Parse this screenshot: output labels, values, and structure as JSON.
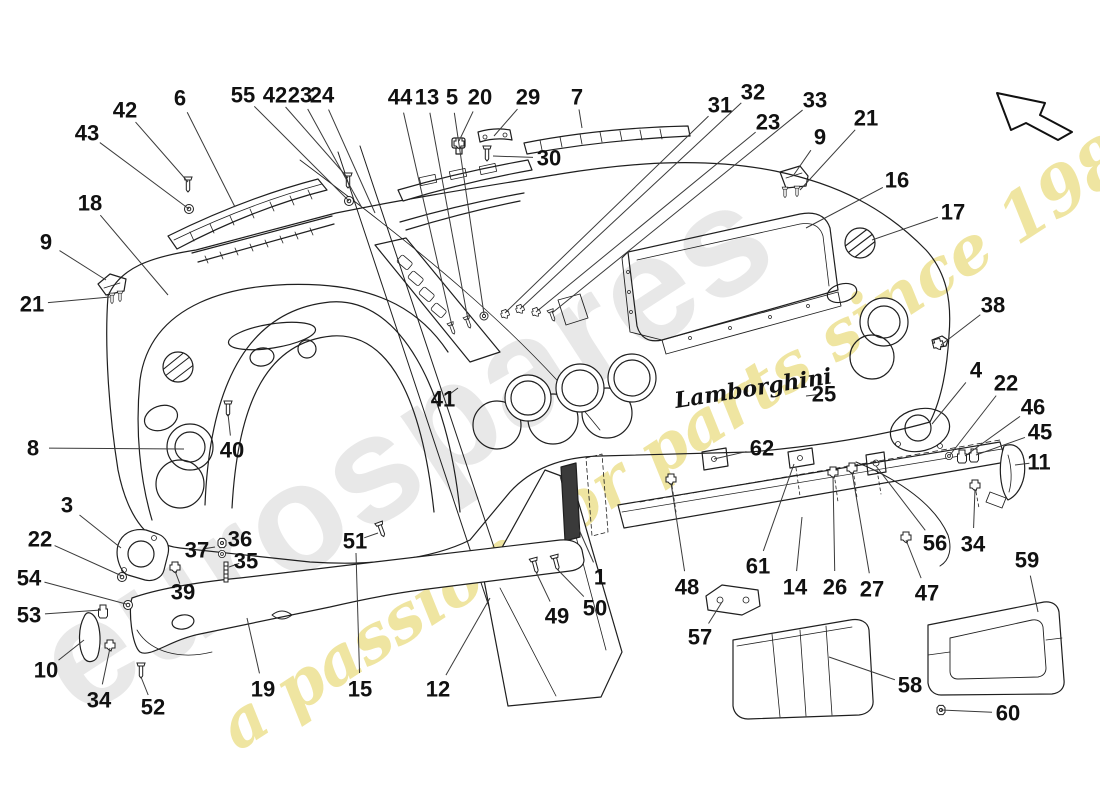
{
  "diagram": {
    "brand_script": "Lamborghini",
    "watermark_brand": "eurospares",
    "watermark_tagline": "a passion for parts since 1985"
  },
  "style": {
    "background": "#ffffff",
    "line_color": "#1f1f1f",
    "leader_color": "#3a3a3a",
    "label_color": "#111111",
    "label_font_size": 22,
    "watermark_brand_color": "#e7e7e7",
    "watermark_tagline_color": "#ecdf8a",
    "dark_part_color": "#3a3a3a"
  },
  "callouts": [
    {
      "n": "43",
      "x": 87,
      "y": 133,
      "tx": 189,
      "ty": 209
    },
    {
      "n": "42",
      "x": 125,
      "y": 110,
      "tx": 188,
      "ty": 182
    },
    {
      "n": "6",
      "x": 180,
      "y": 98,
      "tx": 235,
      "ty": 207
    },
    {
      "n": "55",
      "x": 243,
      "y": 95,
      "tx": 349,
      "ty": 201
    },
    {
      "n": "42",
      "x": 275,
      "y": 95,
      "tx": 348,
      "ty": 178
    },
    {
      "n": "23",
      "x": 300,
      "y": 95,
      "tx": 362,
      "ty": 208
    },
    {
      "n": "24",
      "x": 322,
      "y": 95,
      "tx": 375,
      "ty": 213
    },
    {
      "n": "44",
      "x": 400,
      "y": 97,
      "tx": 452,
      "ty": 326
    },
    {
      "n": "13",
      "x": 427,
      "y": 97,
      "tx": 468,
      "ty": 320
    },
    {
      "n": "5",
      "x": 452,
      "y": 97,
      "tx": 484,
      "ty": 314
    },
    {
      "n": "20",
      "x": 480,
      "y": 97,
      "tx": 459,
      "ty": 141
    },
    {
      "n": "29",
      "x": 528,
      "y": 97,
      "tx": 494,
      "ty": 136
    },
    {
      "n": "7",
      "x": 577,
      "y": 97,
      "tx": 582,
      "ty": 128
    },
    {
      "n": "30",
      "x": 549,
      "y": 158,
      "tx": 493,
      "ty": 156
    },
    {
      "n": "31",
      "x": 720,
      "y": 105,
      "tx": 505,
      "ty": 313
    },
    {
      "n": "32",
      "x": 753,
      "y": 92,
      "tx": 520,
      "ty": 309
    },
    {
      "n": "23",
      "x": 768,
      "y": 122,
      "tx": 536,
      "ty": 312
    },
    {
      "n": "33",
      "x": 815,
      "y": 100,
      "tx": 552,
      "ty": 313
    },
    {
      "n": "9",
      "x": 820,
      "y": 137,
      "tx": 793,
      "ty": 176
    },
    {
      "n": "21",
      "x": 866,
      "y": 118,
      "tx": 800,
      "ty": 190
    },
    {
      "n": "16",
      "x": 897,
      "y": 180,
      "tx": 806,
      "ty": 228
    },
    {
      "n": "17",
      "x": 953,
      "y": 212,
      "tx": 872,
      "ty": 240
    },
    {
      "n": "18",
      "x": 90,
      "y": 203,
      "tx": 168,
      "ty": 295
    },
    {
      "n": "9",
      "x": 46,
      "y": 242,
      "tx": 106,
      "ty": 280
    },
    {
      "n": "21",
      "x": 32,
      "y": 304,
      "tx": 110,
      "ty": 297
    },
    {
      "n": "8",
      "x": 33,
      "y": 448,
      "tx": 184,
      "ty": 449
    },
    {
      "n": "40",
      "x": 232,
      "y": 450,
      "tx": 228,
      "ty": 414
    },
    {
      "n": "41",
      "x": 443,
      "y": 399,
      "tx": 458,
      "ty": 388
    },
    {
      "n": "3",
      "x": 67,
      "y": 505,
      "tx": 121,
      "ty": 548
    },
    {
      "n": "22",
      "x": 40,
      "y": 539,
      "tx": 122,
      "ty": 576
    },
    {
      "n": "54",
      "x": 29,
      "y": 578,
      "tx": 126,
      "ty": 604
    },
    {
      "n": "53",
      "x": 29,
      "y": 615,
      "tx": 101,
      "ty": 610
    },
    {
      "n": "10",
      "x": 46,
      "y": 670,
      "tx": 84,
      "ty": 640
    },
    {
      "n": "34",
      "x": 99,
      "y": 700,
      "tx": 110,
      "ty": 648
    },
    {
      "n": "52",
      "x": 153,
      "y": 707,
      "tx": 141,
      "ty": 677
    },
    {
      "n": "37",
      "x": 197,
      "y": 550,
      "tx": 215,
      "ty": 547
    },
    {
      "n": "36",
      "x": 240,
      "y": 539,
      "tx": 227,
      "ty": 544
    },
    {
      "n": "35",
      "x": 246,
      "y": 561,
      "tx": 229,
      "ty": 567
    },
    {
      "n": "39",
      "x": 183,
      "y": 592,
      "tx": 175,
      "ty": 571
    },
    {
      "n": "19",
      "x": 263,
      "y": 689,
      "tx": 247,
      "ty": 618
    },
    {
      "n": "15",
      "x": 360,
      "y": 689,
      "tx": 356,
      "ty": 553
    },
    {
      "n": "51",
      "x": 355,
      "y": 541,
      "tx": 378,
      "ty": 533
    },
    {
      "n": "12",
      "x": 438,
      "y": 689,
      "tx": 490,
      "ty": 598
    },
    {
      "n": "49",
      "x": 557,
      "y": 616,
      "tx": 536,
      "ty": 572
    },
    {
      "n": "50",
      "x": 595,
      "y": 608,
      "tx": 557,
      "ty": 569
    },
    {
      "n": "1",
      "x": 600,
      "y": 577,
      "tx": 573,
      "ty": 516
    },
    {
      "n": "48",
      "x": 687,
      "y": 587,
      "tx": 671,
      "ty": 483
    },
    {
      "n": "57",
      "x": 700,
      "y": 637,
      "tx": 722,
      "ty": 602
    },
    {
      "n": "61",
      "x": 758,
      "y": 566,
      "tx": 794,
      "ty": 464
    },
    {
      "n": "62",
      "x": 762,
      "y": 448,
      "tx": 714,
      "ty": 459
    },
    {
      "n": "14",
      "x": 795,
      "y": 587,
      "tx": 802,
      "ty": 517
    },
    {
      "n": "26",
      "x": 835,
      "y": 587,
      "tx": 833,
      "ty": 476
    },
    {
      "n": "27",
      "x": 872,
      "y": 589,
      "tx": 852,
      "ty": 472
    },
    {
      "n": "56",
      "x": 935,
      "y": 543,
      "tx": 876,
      "ty": 466
    },
    {
      "n": "34",
      "x": 973,
      "y": 544,
      "tx": 975,
      "ty": 489
    },
    {
      "n": "47",
      "x": 927,
      "y": 593,
      "tx": 906,
      "ty": 540
    },
    {
      "n": "25",
      "x": 824,
      "y": 394,
      "tx": 806,
      "ty": 396
    },
    {
      "n": "38",
      "x": 993,
      "y": 305,
      "tx": 941,
      "ty": 345
    },
    {
      "n": "4",
      "x": 976,
      "y": 370,
      "tx": 932,
      "ty": 424
    },
    {
      "n": "22",
      "x": 1006,
      "y": 383,
      "tx": 950,
      "ty": 455
    },
    {
      "n": "46",
      "x": 1033,
      "y": 407,
      "tx": 965,
      "ty": 456
    },
    {
      "n": "45",
      "x": 1040,
      "y": 432,
      "tx": 976,
      "ty": 455
    },
    {
      "n": "11",
      "x": 1039,
      "y": 462,
      "tx": 1015,
      "ty": 465
    },
    {
      "n": "59",
      "x": 1027,
      "y": 560,
      "tx": 1038,
      "ty": 612
    },
    {
      "n": "58",
      "x": 910,
      "y": 685,
      "tx": 829,
      "ty": 657
    },
    {
      "n": "60",
      "x": 1008,
      "y": 713,
      "tx": 941,
      "ty": 710
    }
  ]
}
